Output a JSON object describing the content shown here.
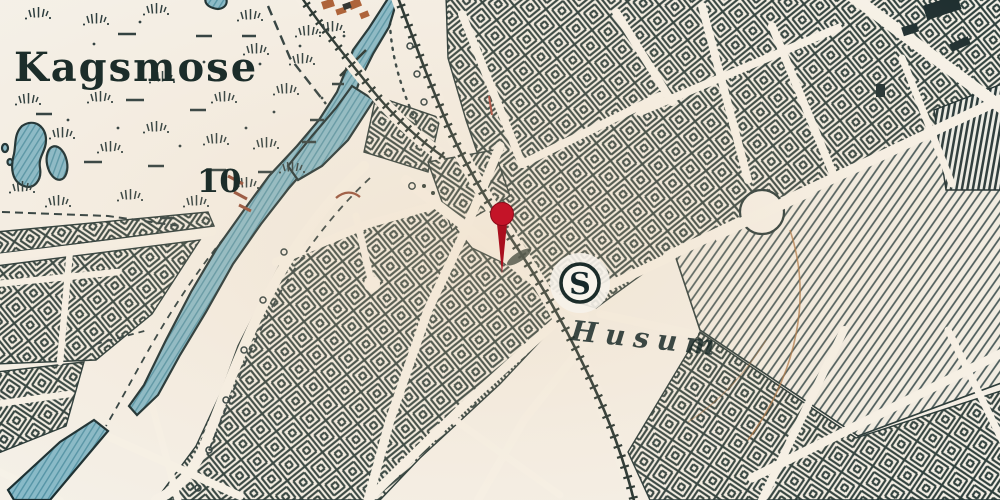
{
  "labels": {
    "bog_name": "Kagsmose",
    "elevation_number": "10"
  },
  "station": {
    "symbol": "S",
    "name": "Husum"
  },
  "marker": {
    "name": "location-pin",
    "color": "#c41428",
    "stem_color": "#a90f1e"
  },
  "colors": {
    "paper": "#f5f1e9",
    "ink": "#26383a",
    "line_dark": "#1d2d2b",
    "water": "#85b9c9",
    "water_line": "#4f92a6",
    "contour_brown": "#a9713f",
    "building_brown": "#a85a30"
  }
}
